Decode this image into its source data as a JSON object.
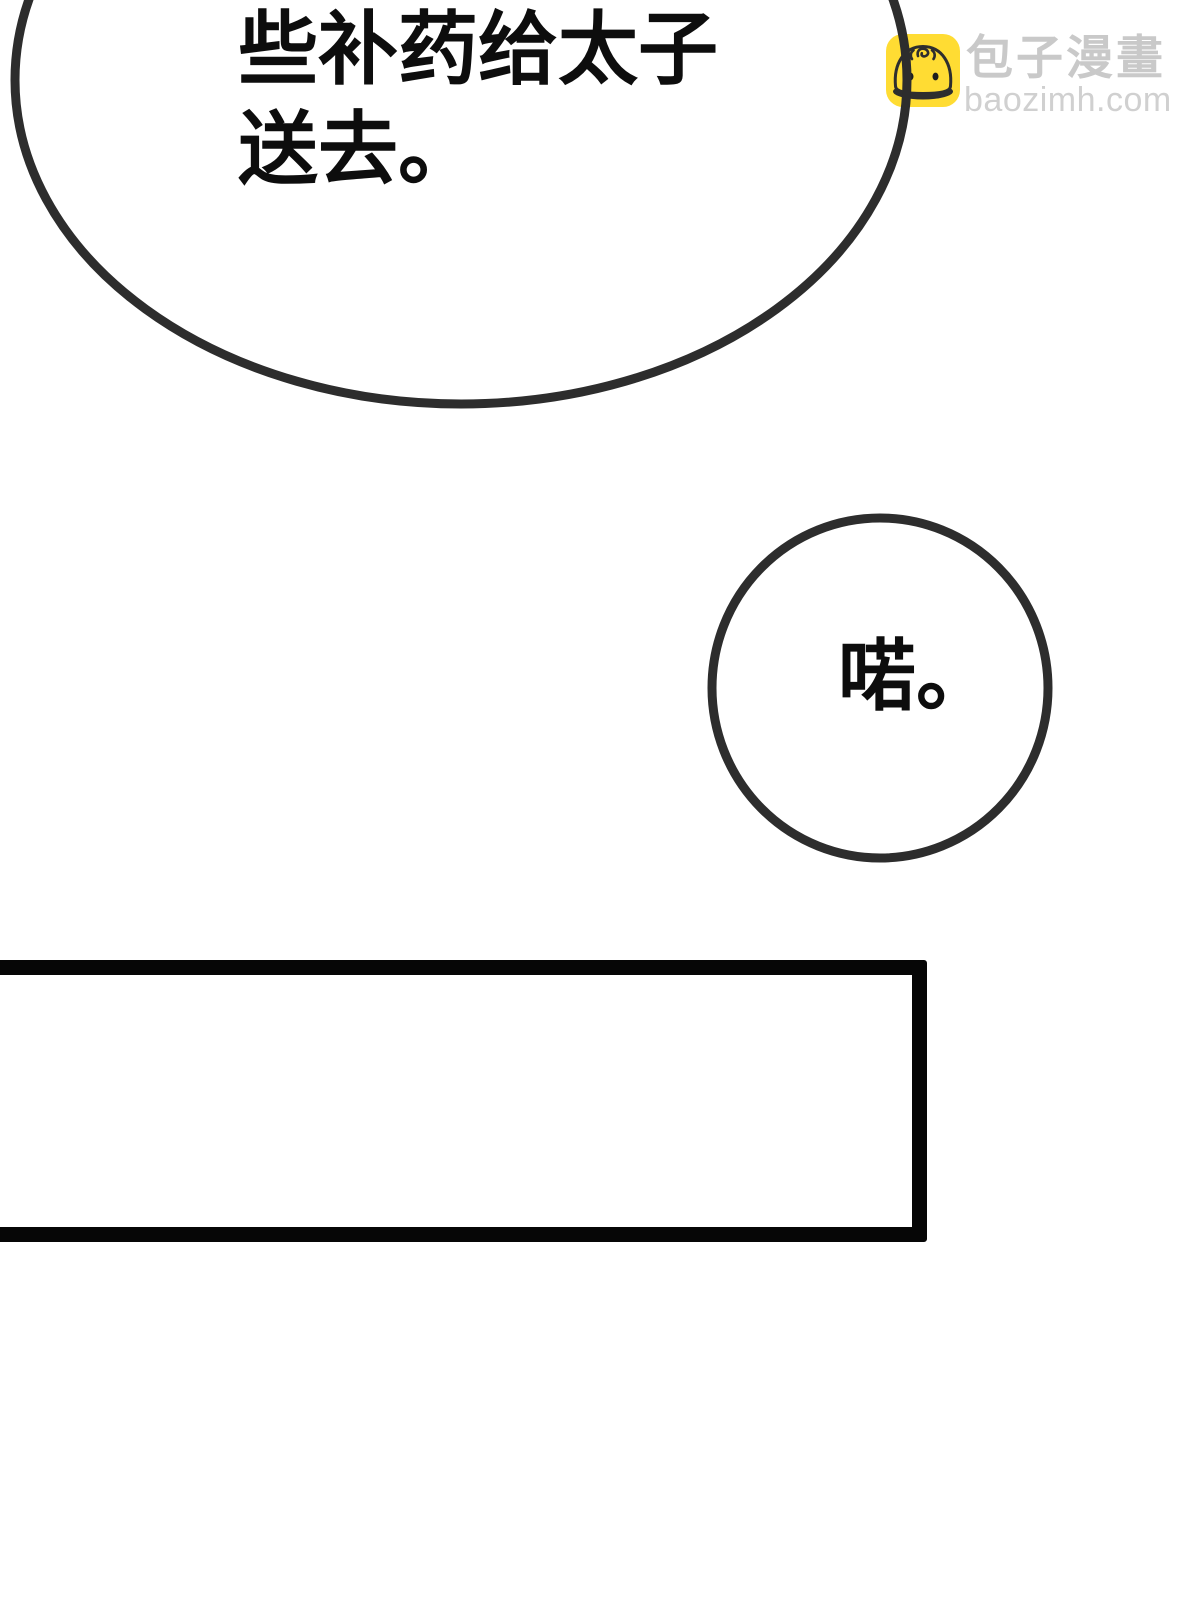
{
  "watermark": {
    "brand_cn": "包子漫畫",
    "brand_domain": "baozimh.com",
    "icon": "baozi-bun-icon",
    "icon_bg": "#ffdc33",
    "icon_line": "#2e2e2e",
    "text_color_cn": "#c9c9c9",
    "text_color_domain": "#d0d0d0"
  },
  "art": {
    "stroke_color": "#2d2d2d",
    "panel_border_color": "#060606",
    "page_background": "#ffffff"
  },
  "speech_bubbles": {
    "main": {
      "shape": "ellipse-cropped-at-top",
      "lines": [
        "些补药给太子",
        "送去。"
      ]
    },
    "reply": {
      "shape": "circle",
      "text": "喏。"
    }
  }
}
